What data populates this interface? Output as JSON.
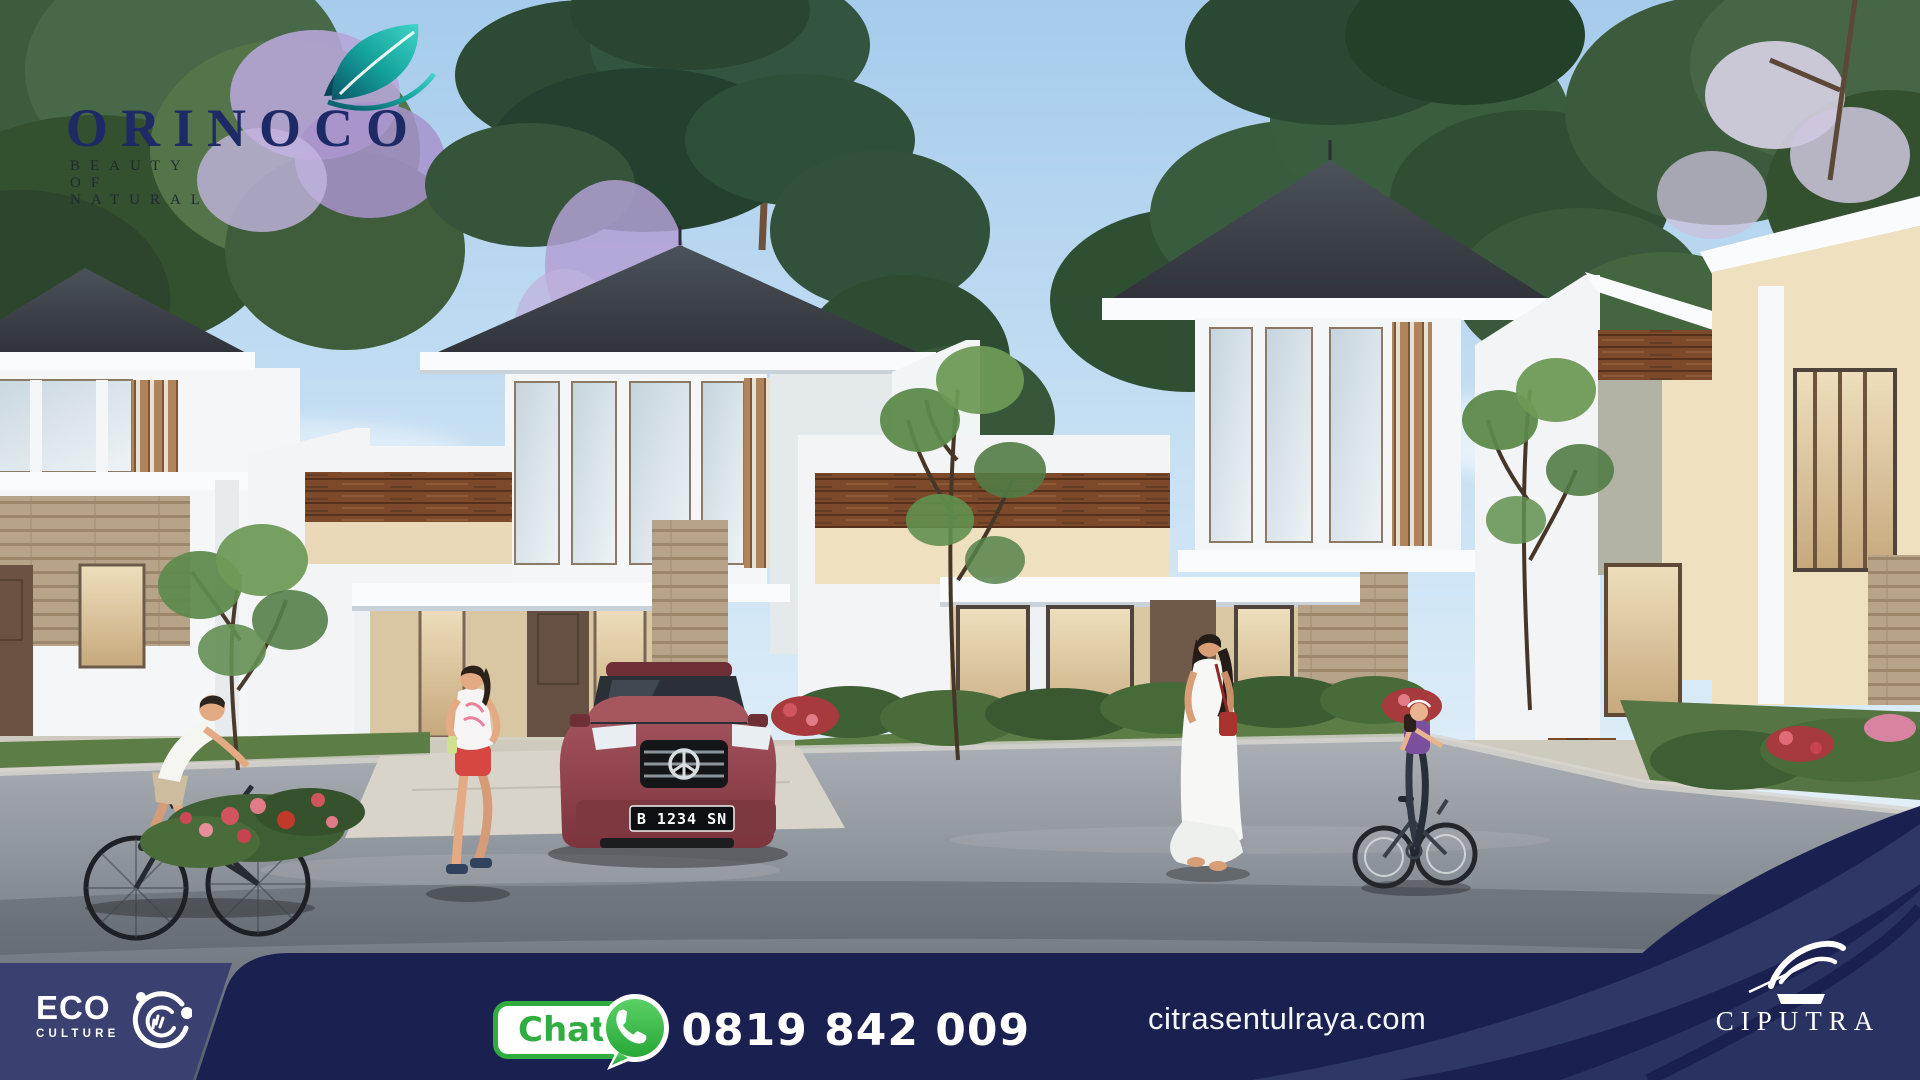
{
  "brand": {
    "name": "ORINOCO",
    "tagline": "BEAUTY OF NATURAL",
    "leaf_icon": "teal-leaf-icon"
  },
  "scene": {
    "description": "3D render of modern tropical one-storey houses with dark hip roofs, wood and stone accents, residents cycling, jogging and walking on the street",
    "car_plate": "B 1234 SN"
  },
  "footer": {
    "eco_badge": {
      "line1": "ECO",
      "line2": "CULTURE",
      "icon": "eco-swirl-icon"
    },
    "chat": {
      "label": "Chat",
      "icon": "whatsapp-icon",
      "phone": "0819 842 009"
    },
    "website": "citrasentulraya.com",
    "developer": {
      "name": "CIPUTRA",
      "icon": "ciputra-swoosh-icon"
    }
  },
  "colors": {
    "bar_navy": "#1a2150",
    "eco_panel_navy": "#3a4170",
    "swoosh_navy": "#2e3766",
    "chat_green": "#2fae3f",
    "whatsapp_green": "#38b64a",
    "orinoco_navy": "#1d2a66",
    "leaf_teal": "#1cb8ac",
    "car_maroon": "#93414a",
    "sky_blue": "#a6cbec"
  }
}
